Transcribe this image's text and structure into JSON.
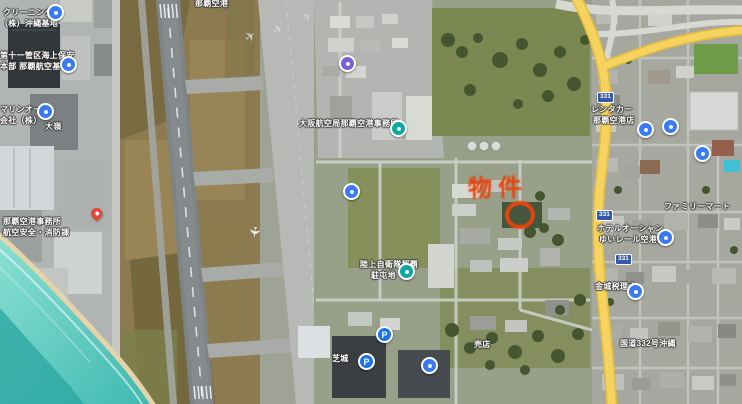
{
  "page": {
    "title": "那覇空港 衛星写真マップ"
  },
  "annotation": {
    "text": "物件",
    "color": "#e8430d"
  },
  "icons": {
    "airplane": "✈",
    "parking_glyph": "P"
  },
  "colors": {
    "yellow_road": "#f6d35e",
    "ocean": "#5ecdc2",
    "annotation_red": "#e8430d"
  },
  "labels": [
    {
      "name": "shop-line1",
      "text": "クリーニング"
    },
    {
      "name": "shop-line2",
      "text": "（株）沖縄基地"
    },
    {
      "name": "coast-guard-line1",
      "text": "第十一管区海上保安"
    },
    {
      "name": "coast-guard-line2",
      "text": "本部 那覇航空基地"
    },
    {
      "name": "company-line1",
      "text": "マリンオート"
    },
    {
      "name": "company-line2",
      "text": "会社（株）"
    },
    {
      "name": "omine",
      "text": "大嶺"
    },
    {
      "name": "naha-airport",
      "text": "那覇空港"
    },
    {
      "name": "airport-office-line1",
      "text": "那覇空港事務所"
    },
    {
      "name": "airport-office-line2",
      "text": "航空安全・消防課"
    },
    {
      "name": "osaka-aviation-bureau",
      "text": "大阪航空局那覇空港事務所"
    },
    {
      "name": "jsdf-line1",
      "text": "陸上自衛隊那覇"
    },
    {
      "name": "jsdf-line2",
      "text": "駐屯地"
    },
    {
      "name": "shibagusuku",
      "text": "芝城"
    },
    {
      "name": "baiten",
      "text": "売店"
    },
    {
      "name": "rentacar-line1",
      "text": "レンタカー"
    },
    {
      "name": "rentacar-line2",
      "text": "那覇空港店"
    },
    {
      "name": "hotel-line1",
      "text": "ホテルオーシャン"
    },
    {
      "name": "hotel-line2",
      "text": "ゆいレール空港前"
    },
    {
      "name": "conbini",
      "text": "ファミリーマート"
    },
    {
      "name": "zeirishi",
      "text": "金城税理士"
    },
    {
      "name": "route332",
      "text": "国道332号沖縄"
    }
  ],
  "route_shields": [
    {
      "number": "331"
    },
    {
      "number": "331"
    },
    {
      "number": "331"
    }
  ]
}
